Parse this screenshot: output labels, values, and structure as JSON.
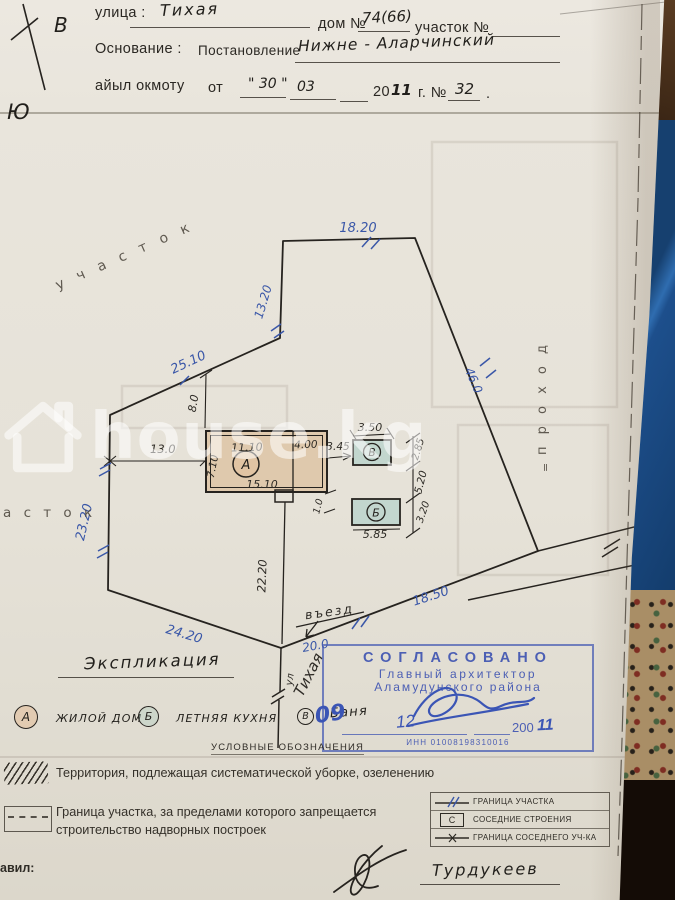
{
  "header": {
    "street_label": "улица :",
    "street_value": "Тихая",
    "house_label": "дом №",
    "house_value": "74(66)",
    "plot_label": "участок №",
    "basis_label": "Основание :",
    "basis_doc": "Постановление",
    "basis_value": "Нижне - Аларчинский",
    "ayyl_label": "айыл окмоту",
    "from_label": "от",
    "day_value": "\" 30 \"",
    "month_value": "03",
    "year_printed": "20",
    "year_hand": "11",
    "year_suffix": "г. №",
    "number_value": "32",
    "dot": "."
  },
  "compass": {
    "east": "В",
    "south": "Ю"
  },
  "plan": {
    "labels": {
      "plot_top": "у ч а с т о к",
      "plot_left": "а с т о к",
      "passage": "п р о х о д",
      "passage_mark": "=",
      "entrance": "въезд",
      "street_abbr": "ул",
      "street_name": "Тихая",
      "street_front": "20.0"
    },
    "dims": {
      "top": "18.20",
      "ne": "13.20",
      "nw": "25.10",
      "west": "23.20",
      "sw": "24.20",
      "east": "46.0",
      "south": "18.50",
      "yard": "22.20",
      "house_offset_w": "13.0",
      "house_offset_n": "8.0",
      "gap_a_b": "3.45",
      "a_w1": "11.10",
      "a_w2": "4.00",
      "a_h": "7.10",
      "a_total": "15.10",
      "a_porch": "1.0",
      "b_top": "3.50",
      "b_side": "2.85",
      "gap_b_c": "5.20",
      "c_side": "3.20",
      "c_bottom": "5.85"
    },
    "buildings": {
      "house": "А",
      "bath": "В",
      "kitchen": "Б"
    }
  },
  "explication": {
    "title": "Экспликация",
    "items": [
      {
        "key": "А",
        "label": "ЖИЛОЙ ДОМ"
      },
      {
        "key": "Б",
        "label": "ЛЕТНЯЯ КУХНЯ"
      },
      {
        "key": "В",
        "label": "Баня"
      }
    ]
  },
  "stamp": {
    "title": "СОГЛАСОВАНО",
    "line2": "Главный архитектор",
    "line3": "Аламудунского района",
    "day": "09",
    "month": "12",
    "year_printed": "200",
    "year_hand": "11",
    "inn": "ИНН 01008198310016"
  },
  "conventions": {
    "title": "УСЛОВНЫЕ ОБОЗНАЧЕНИЯ",
    "hatch_label": "Территория, подлежащая систематической уборке, озеленению",
    "dashed_label": "Граница участка, за пределами которого запрещается строительство надворных построек",
    "table": [
      {
        "label": "ГРАНИЦА УЧАСТКА"
      },
      {
        "sym": "С",
        "label": "СОСЕДНИЕ СТРОЕНИЯ"
      },
      {
        "label": "ГРАНИЦА СОСЕДНЕГО УЧ-КА"
      }
    ]
  },
  "footer": {
    "made_by": "авил:",
    "surname": "Турдукеев"
  },
  "watermark": {
    "text": "house.kg"
  },
  "colors": {
    "ink_blue": "#3a57a8",
    "ink_black": "#26231f",
    "stamp_blue": "#4c5fb4",
    "building_tan": "#dfc9ad",
    "building_teal": "#c2d6ce",
    "paper": "#e8e4db"
  }
}
